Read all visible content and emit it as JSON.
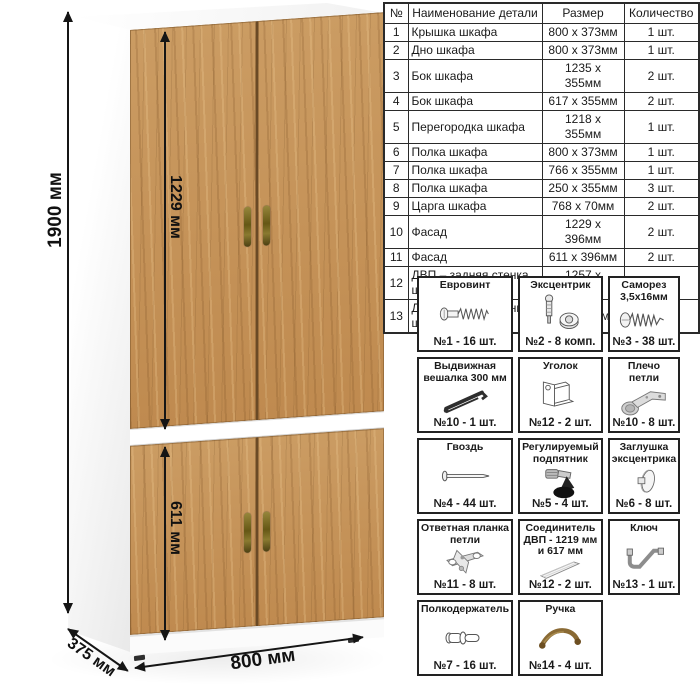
{
  "dims": {
    "height": "1900 мм",
    "upper_door": "1229 мм",
    "lower_door": "611 мм",
    "width": "800 мм",
    "depth": "375 мм"
  },
  "parts_table": {
    "headers": [
      "№",
      "Наименование детали",
      "Размер",
      "Количество"
    ],
    "rows": [
      [
        "1",
        "Крышка шкафа",
        "800 х 373мм",
        "1 шт."
      ],
      [
        "2",
        "Дно шкафа",
        "800 х 373мм",
        "1 шт."
      ],
      [
        "3",
        "Бок шкафа",
        "1235 х 355мм",
        "2 шт."
      ],
      [
        "4",
        "Бок шкафа",
        "617 х 355мм",
        "2 шт."
      ],
      [
        "5",
        "Перегородка шкафа",
        "1218 х 355мм",
        "1 шт."
      ],
      [
        "6",
        "Полка шкафа",
        "800 х 373мм",
        "1 шт."
      ],
      [
        "7",
        "Полка шкафа",
        "766 х 355мм",
        "1 шт."
      ],
      [
        "8",
        "Полка шкафа",
        "250 х 355мм",
        "3 шт."
      ],
      [
        "9",
        "Царга шкафа",
        "768 х 70мм",
        "2 шт."
      ],
      [
        "10",
        "Фасад",
        "1229 х 396мм",
        "2 шт."
      ],
      [
        "11",
        "Фасад",
        "611 х 396мм",
        "2 шт."
      ],
      [
        "12",
        "ДВП – задняя стенка шкафа",
        "1257 х 396мм",
        "2 шт."
      ],
      [
        "13",
        "ДВП – задняя стенка шкафа",
        "639 х 396мм",
        "2 шт."
      ]
    ]
  },
  "hardware": {
    "items": [
      {
        "title": "Евровинт",
        "icon": "euro-screw-icon",
        "qty": "№1 - 16 шт."
      },
      {
        "title": "Эксцентрик",
        "icon": "eccentric-cam-icon",
        "qty": "№2 - 8 комп."
      },
      {
        "title": "Саморез 3,5х16мм",
        "icon": "tapping-screw-icon",
        "qty": "№3 - 38 шт."
      },
      {
        "title": "Выдвижная вешалка 300 мм",
        "icon": "pullout-hanger-icon",
        "qty": "№10 - 1 шт."
      },
      {
        "title": "Уголок",
        "icon": "corner-bracket-icon",
        "qty": "№12 - 2 шт."
      },
      {
        "title": "Плечо петли",
        "icon": "hinge-arm-icon",
        "qty": "№10 - 8 шт."
      },
      {
        "title": "Гвоздь",
        "icon": "nail-icon",
        "qty": "№4 - 44 шт."
      },
      {
        "title": "Регулируемый подпятник",
        "icon": "adjustable-foot-icon",
        "qty": "№5 - 4 шт."
      },
      {
        "title": "Заглушка эксцентрика",
        "icon": "cam-cap-icon",
        "qty": "№6 - 8 шт."
      },
      {
        "title": "Ответная планка петли",
        "icon": "hinge-plate-icon",
        "qty": "№11 - 8 шт."
      },
      {
        "title": "Соединитель ДВП - 1219 мм и 617 мм",
        "icon": "hdf-connector-icon",
        "qty": "№12 - 2 шт."
      },
      {
        "title": "Ключ",
        "icon": "hex-key-icon",
        "qty": "№13 - 1 шт."
      },
      {
        "title": "Полкодержатель",
        "icon": "shelf-pin-icon",
        "qty": "№7 - 16 шт."
      },
      {
        "title": "Ручка",
        "icon": "handle-icon",
        "qty": "№14 - 4 шт."
      }
    ]
  },
  "colors": {
    "wood": "#c2905a",
    "handle_bronze": "#7a6a2d",
    "line": "#151515"
  }
}
